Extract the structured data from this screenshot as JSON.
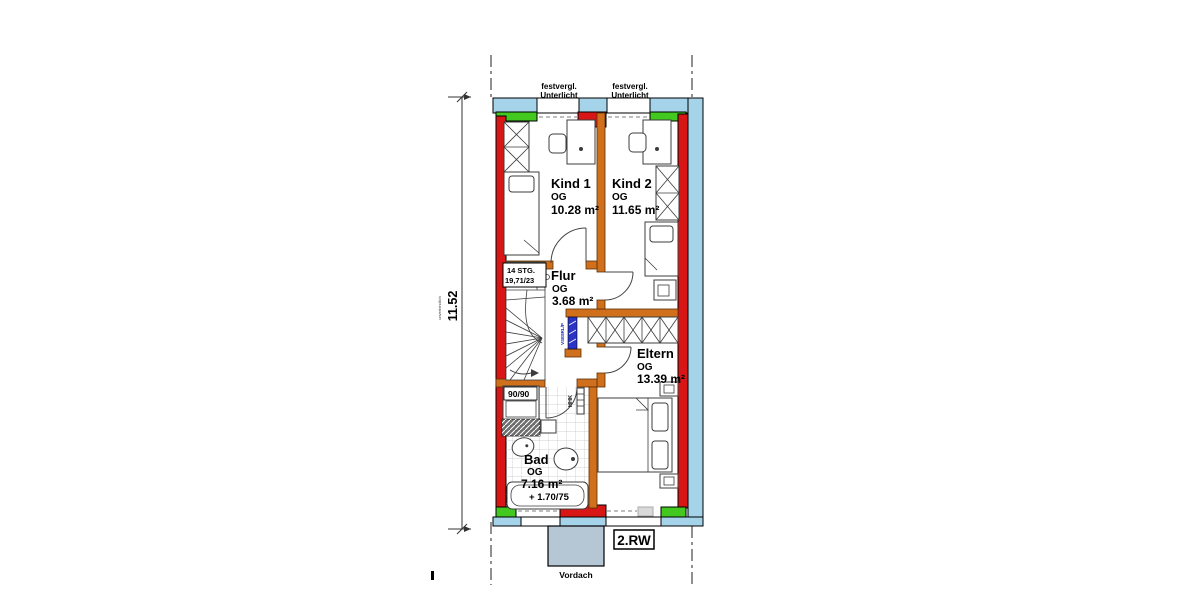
{
  "colors": {
    "exterior_glass_blue": "#a5d3ea",
    "window_green": "#42c81e",
    "wall_red": "#d81616",
    "wall_orange": "#d1701c",
    "radiator_blue": "#2a35c8",
    "canopy_gray": "#b5c6d4"
  },
  "top_annotations": {
    "left_window": {
      "line1": "festvergl.",
      "line2": "Unterlicht"
    },
    "right_window": {
      "line1": "festvergl.",
      "line2": "Unterlicht"
    }
  },
  "rooms": {
    "kind1": {
      "name": "Kind 1",
      "level": "OG",
      "area": "10.28 m²"
    },
    "kind2": {
      "name": "Kind 2",
      "level": "OG",
      "area": "11.65 m²"
    },
    "flur": {
      "name": "Flur",
      "level": "OG",
      "area": "3.68 m²"
    },
    "eltern": {
      "name": "Eltern",
      "level": "OG",
      "area": "13.39 m²"
    },
    "bad": {
      "name": "Bad",
      "level": "OG",
      "area": "7.16 m²"
    }
  },
  "stairs": {
    "line1": "14 STG.",
    "line2": "19,71/23"
  },
  "fixtures": {
    "shower": "90/90",
    "bathtub": "+ 1.70/75",
    "towel_radiator": "HHK",
    "radiator_code": "VSE8RL/P"
  },
  "dimension": {
    "value": "11.52",
    "note": "unverbindlich"
  },
  "footer": {
    "rw": "2.RW",
    "canopy": "Vordach"
  }
}
